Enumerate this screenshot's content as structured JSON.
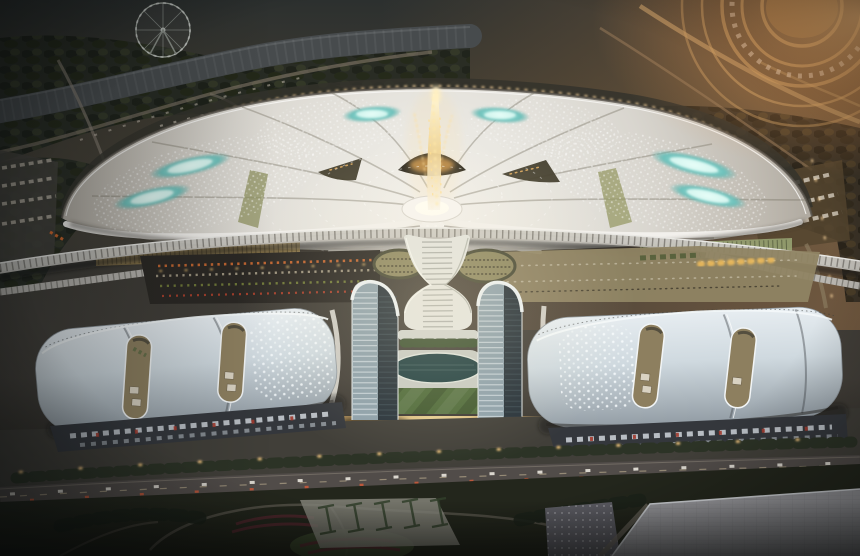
{
  "meta": {
    "type": "architectural-aerial-rendering",
    "time_of_day": "dusk",
    "description": "Aerial dusk rendering of a huge fan-shaped exhibition/convention center with a glowing golden central spire, teal roof skylights, an elevated viaduct crossing in front, twin curved glass towers framing an oval pool, striped lawn and warm-lit plaza, flanked by two wavy white exhibition halls with slot skylights, loading docks, a main road, landscaped parks, a ferris wheel at upper left and a curved racetrack complex at upper right."
  },
  "features": {
    "ferris_wheel": 1,
    "teal_skylights": 6,
    "dark_roof_openings": 3,
    "central_spire": 1,
    "glass_towers": 2,
    "exhibition_halls": 2,
    "hall_slot_openings": 4,
    "oval_pool": 1,
    "striped_lawn": 1,
    "viaduct": 1,
    "main_road": 1,
    "racetrack_arcs": 5
  },
  "palette": {
    "base_ground": "#2b2d28",
    "dusk_left": "#282c2c",
    "sunset_glow": "#d29a62",
    "water": "#474b4d",
    "tree_dark": "#272b23",
    "tree_warm": "#3a3226",
    "road_tan": "#85796a",
    "racetrack_tan": "#c9a067",
    "fan_roof_light": "#f2f0ec",
    "fan_roof_shadow": "#a9a399",
    "fan_rim_dark": "#34322b",
    "teal_glow": "#6cc0ba",
    "teal_core": "#eafff9",
    "gold_light": "#ffd98f",
    "amber_glass": "#b59a5e",
    "green_glass": "#9fae7a",
    "viaduct_deck": "#c9c7c1",
    "plaza_dark": "#2b2824",
    "plaza_tan": "#8f8463",
    "stall_orange": "#cf6a32",
    "hall_roof_light": "#e7edf1",
    "hall_roof_shadow": "#949ea6",
    "slot_interior": "#8d7f5f",
    "dock_dark": "#34373c",
    "truck_light": "#c7ccd1",
    "truck_red": "#a23a2e",
    "tower_glass_light": "#8da0aa",
    "tower_glass_dark": "#27323a",
    "tower_trim": "#eef2f4",
    "spine_white": "#e2e3de",
    "pool_teal": "#214042",
    "lawn_green": "#4e6a3a",
    "plaza_warm_bright": "#f0dfa8",
    "road_asphalt": "#514c49",
    "streetlight_warm": "#ffcf86",
    "park_dark": "#23261c",
    "path_light": "#6b665c",
    "hedge_green": "#31402a",
    "flower_red": "#562830",
    "flat_roof_grey": "#98989c",
    "paving_grey": "#5d5d64",
    "headlight": "#e9e6dd",
    "taillight": "#cf5b3a"
  }
}
